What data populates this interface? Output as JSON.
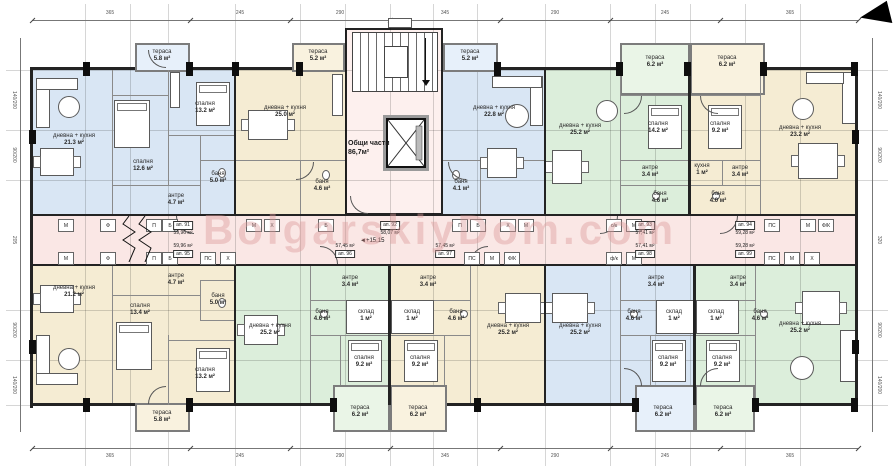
{
  "watermark": "BolgarskiyDom.com",
  "level_mark": "+15,15",
  "core": {
    "name": "Общи части",
    "area": "86,7м²"
  },
  "rooms": [
    {
      "n": "дневна + кухня",
      "a": "21.3 м²"
    },
    {
      "n": "спалня",
      "a": "13.2 м²"
    },
    {
      "n": "спалня",
      "a": "12.6 м²"
    },
    {
      "n": "баня",
      "a": "5.0 м²"
    },
    {
      "n": "антре",
      "a": "4.7 м²"
    },
    {
      "n": "тераса",
      "a": "5.8 м²"
    },
    {
      "n": "дневна + кухня",
      "a": "25.0 м²"
    },
    {
      "n": "тераса",
      "a": "5.2 м²"
    },
    {
      "n": "баня",
      "a": "4.6 м²"
    },
    {
      "n": "тераса",
      "a": "5.2 м²"
    },
    {
      "n": "дневна + кухня",
      "a": "22.8 м²"
    },
    {
      "n": "баня",
      "a": "4.1 м²"
    },
    {
      "n": "дневна + кухня",
      "a": "25.2 м²"
    },
    {
      "n": "тераса",
      "a": "6.2 м²"
    },
    {
      "n": "спалня",
      "a": "14.2 м²"
    },
    {
      "n": "антре",
      "a": "3.4 м²"
    },
    {
      "n": "баня",
      "a": "4.6 м²"
    },
    {
      "n": "тераса",
      "a": "6.2 м²"
    },
    {
      "n": "спалня",
      "a": "9.2 м²"
    },
    {
      "n": "кухня",
      "a": "1 м²"
    },
    {
      "n": "антре",
      "a": "3.4 м²"
    },
    {
      "n": "баня",
      "a": "4.0 м²"
    },
    {
      "n": "дневна + кухня",
      "a": "23.2 м²"
    },
    {
      "n": "дневна + кухня",
      "a": "21.2 м²"
    },
    {
      "n": "антре",
      "a": "4.7 м²"
    },
    {
      "n": "баня",
      "a": "5.0 м²"
    },
    {
      "n": "спалня",
      "a": "13.4 м²"
    },
    {
      "n": "спалня",
      "a": "13.2 м²"
    },
    {
      "n": "тераса",
      "a": "5.8 м²"
    },
    {
      "n": "дневна + кухня",
      "a": "25.2 м²"
    },
    {
      "n": "антре",
      "a": "3.4 м²"
    },
    {
      "n": "баня",
      "a": "4.6 м²"
    },
    {
      "n": "склад",
      "a": "1 м²"
    },
    {
      "n": "спалня",
      "a": "9.2 м²"
    },
    {
      "n": "тераса",
      "a": "6.2 м²"
    },
    {
      "n": "антре",
      "a": "3.4 м²"
    },
    {
      "n": "баня",
      "a": "4.6 м²"
    },
    {
      "n": "склад",
      "a": "1 м²"
    },
    {
      "n": "спалня",
      "a": "9.2 м²"
    },
    {
      "n": "тераса",
      "a": "6.2 м²"
    },
    {
      "n": "дневна + кухня",
      "a": "25.2 м²"
    },
    {
      "n": "дневна + кухня",
      "a": "25.2 м²"
    },
    {
      "n": "антре",
      "a": "3.4 м²"
    },
    {
      "n": "баня",
      "a": "4.6 м²"
    },
    {
      "n": "склад",
      "a": "1 м²"
    },
    {
      "n": "спалня",
      "a": "9.2 м²"
    },
    {
      "n": "тераса",
      "a": "6.2 м²"
    },
    {
      "n": "склад",
      "a": "1 м²"
    },
    {
      "n": "спалня",
      "a": "9.2 м²"
    },
    {
      "n": "тераса",
      "a": "6.2 м²"
    },
    {
      "n": "антре",
      "a": "3.4 м²"
    },
    {
      "n": "баня",
      "a": "4.6 м²"
    },
    {
      "n": "дневна + кухня",
      "a": "25.2 м²"
    }
  ],
  "units": [
    {
      "no": "ап. 91",
      "area": "59,96 м²"
    },
    {
      "no": "ап. 92",
      "area": "58,07 м²"
    },
    {
      "no": "ап. 93",
      "area": "57,41 м²"
    },
    {
      "no": "ап. 94",
      "area": "59,28 м²"
    },
    {
      "no": "ап. 95",
      "area": "59,96 м²"
    },
    {
      "no": "ап. 96",
      "area": "57,45 м²"
    },
    {
      "no": "ап. 97",
      "area": "57,45 м²"
    },
    {
      "no": "ап. 98",
      "area": "57,41 м²"
    },
    {
      "no": "ап. 99",
      "area": "59,28 м²"
    }
  ],
  "counters": [
    "М",
    "Ф",
    "П",
    "Б",
    "М",
    "Х",
    "Б",
    "П",
    "Б",
    "Х",
    "М",
    "о/к",
    "М",
    "ПС",
    "М",
    "Ф/К",
    "М",
    "Ф",
    "П",
    "Б",
    "ПС",
    "Х",
    "ПС",
    "М",
    "Ф/К",
    "ф/к",
    "М",
    "ПС",
    "М",
    "Х"
  ],
  "dims": {
    "top": [
      "365",
      "245",
      "290",
      "345",
      "290",
      "245",
      "365"
    ],
    "bottom": [
      "365",
      "245",
      "290",
      "345",
      "290",
      "245",
      "365"
    ],
    "left": [
      "140/200",
      "90/200",
      "205",
      "90/200",
      "140/200"
    ],
    "right": [
      "140/200",
      "90/200",
      "320",
      "90/200",
      "140/200"
    ]
  }
}
